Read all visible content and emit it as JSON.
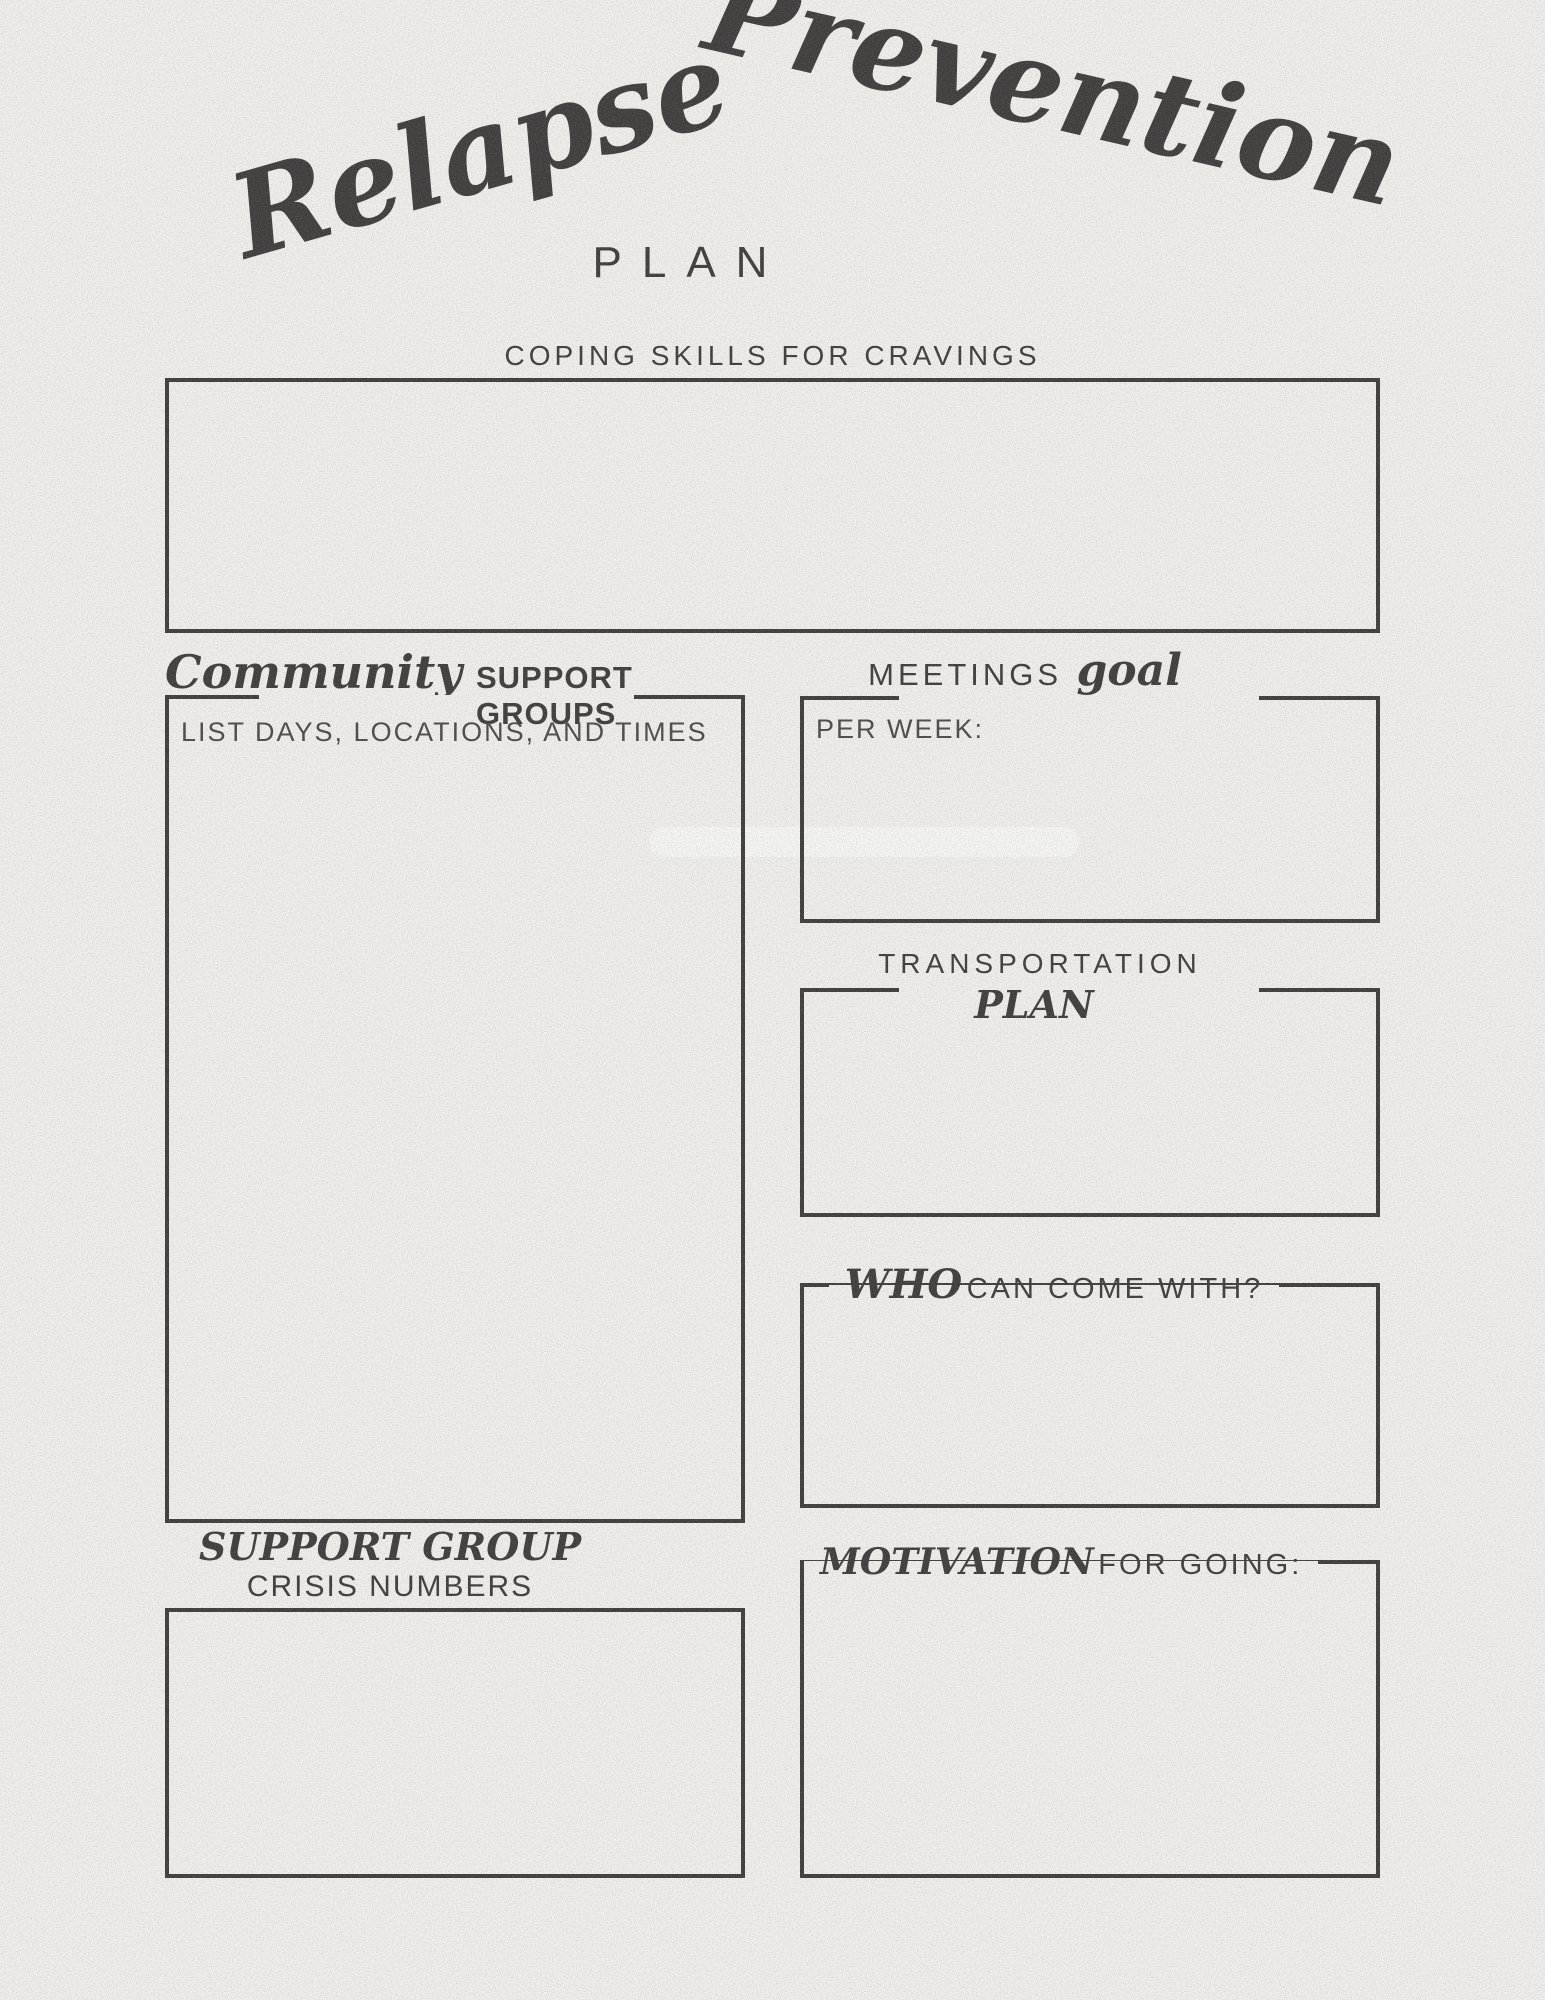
{
  "colors": {
    "paper": "#f1f0ed",
    "ink": "#3d3c3c"
  },
  "header": {
    "title_word1": "Relapse",
    "title_word2": "Prevention",
    "subtitle": "PLAN"
  },
  "sections": {
    "coping_skills": {
      "label": "COPING SKILLS FOR CRAVINGS"
    },
    "community_support": {
      "heading_script": "Community",
      "heading_caps": "SUPPORT GROUPS",
      "hint": "LIST DAYS, LOCATIONS, AND TIMES"
    },
    "meetings_goal": {
      "heading_caps": "MEETINGS",
      "heading_script": "goal",
      "inner_label": "PER WEEK:"
    },
    "transportation": {
      "heading_caps": "TRANSPORTATION",
      "heading_script": "PLAN"
    },
    "who_can_come": {
      "heading_script": "WHO",
      "heading_caps": "CAN COME WITH?"
    },
    "crisis_numbers": {
      "heading_script": "SUPPORT GROUP",
      "heading_caps": "CRISIS NUMBERS"
    },
    "motivation": {
      "heading_script": "MOTIVATION",
      "heading_caps": "FOR GOING:"
    }
  }
}
